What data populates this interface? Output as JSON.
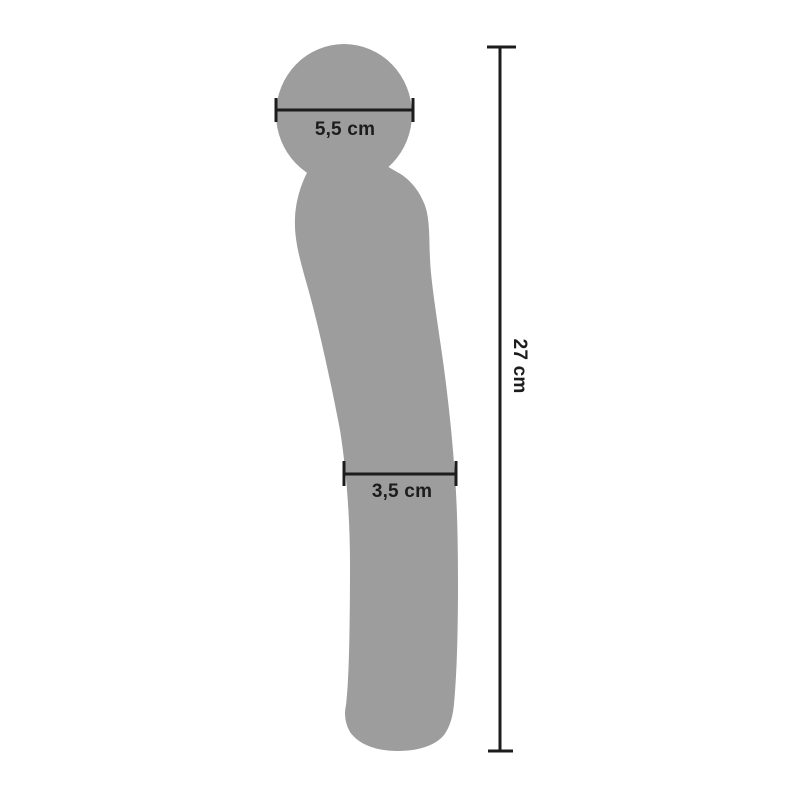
{
  "colors": {
    "background": "#ffffff",
    "silhouette": "#9d9d9d",
    "measurement": "#1c1c1c"
  },
  "measurements": {
    "head_width": "5,5 cm",
    "shaft_width": "3,5 cm",
    "total_length": "27 cm"
  }
}
